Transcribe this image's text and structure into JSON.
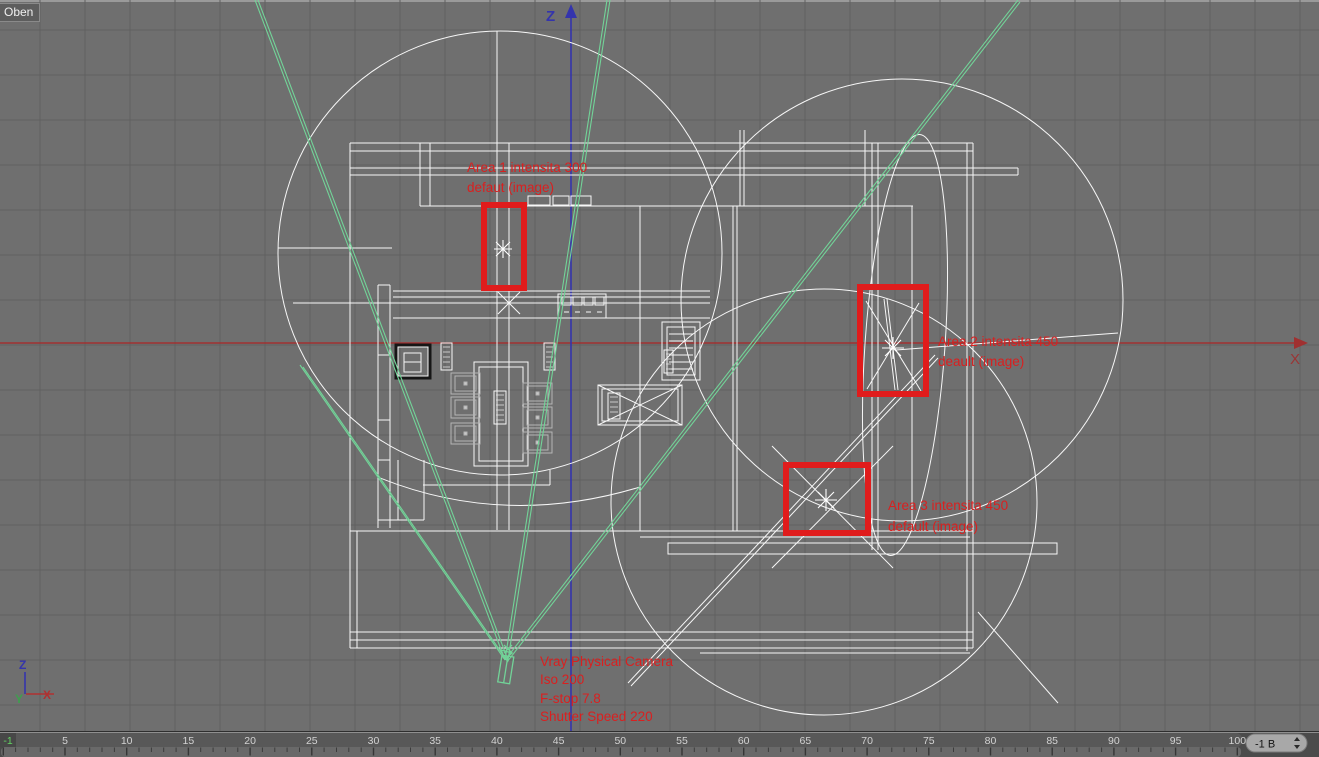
{
  "viewport": {
    "label": "Oben",
    "axes": {
      "top_axis_label": "Z",
      "right_axis_label": "X",
      "tripod": {
        "x": "X",
        "y": "Y",
        "z": "Z"
      }
    },
    "annotations": {
      "area1": {
        "line1": "Area 1 intensita 300",
        "line2": "defaut (image)"
      },
      "area2": {
        "line1": "Area 2 intensita 450",
        "line2": "deault (image)"
      },
      "area3": {
        "line1": "Area 3 intensita 450",
        "line2": "default (image)"
      },
      "camera": {
        "line1": "Vray Physical Camera",
        "line2": "Iso 200",
        "line3": "F-stop 7.8",
        "line4": "Shutter Speed 220"
      }
    },
    "colors": {
      "background": "#6f6f6f",
      "grid": "#606060",
      "wireframe": "#f7f7f7",
      "camera_rays": "#72d398",
      "highlight_red": "#e01c1c",
      "annotation_red": "#d92020",
      "x_axis_red": "#a03030",
      "z_axis_blue": "#3434ad"
    }
  },
  "timeline": {
    "current_frame": "-1",
    "frame_labels": [
      "5",
      "10",
      "15",
      "20",
      "25",
      "30",
      "35",
      "40",
      "45",
      "50",
      "55",
      "60",
      "65",
      "70",
      "75",
      "80",
      "85",
      "90",
      "95",
      "100"
    ],
    "frame_field_value": "-1 B"
  }
}
